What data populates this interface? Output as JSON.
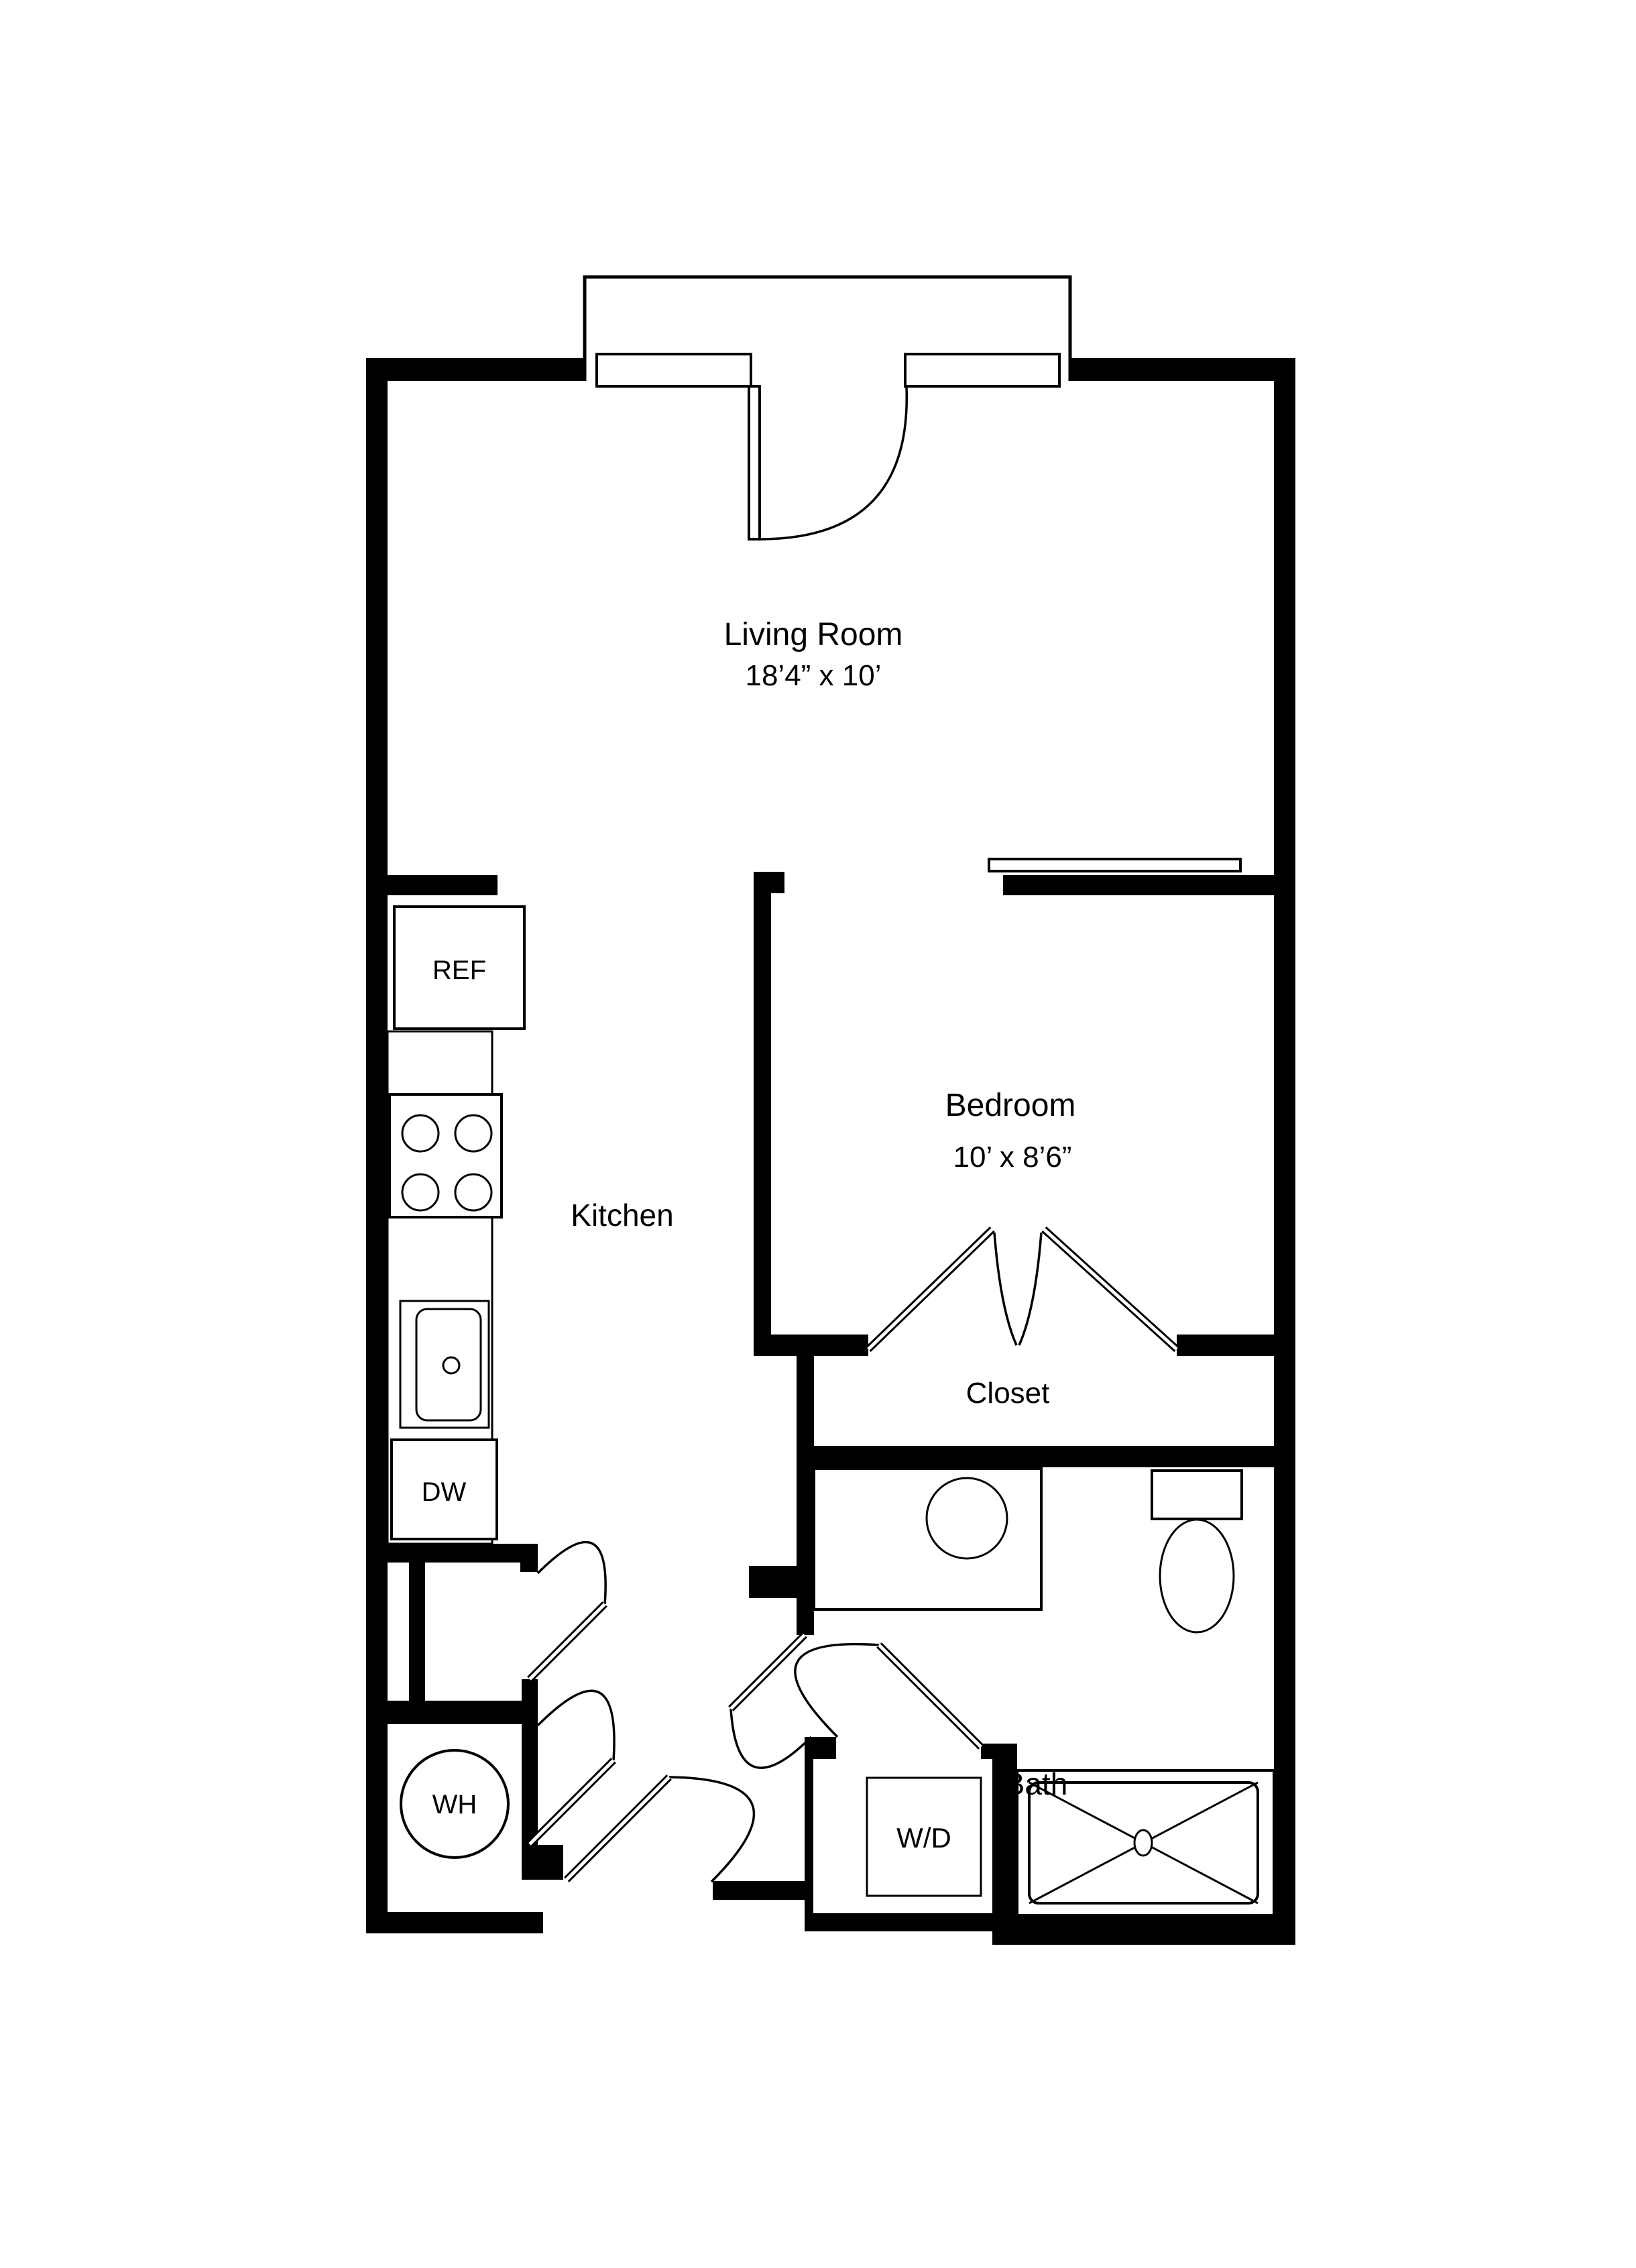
{
  "page": {
    "background": "#ffffff",
    "line_color": "#000000"
  },
  "rooms": {
    "living_room": {
      "label": "Living Room",
      "dimensions": "18’4” x 10’"
    },
    "kitchen": {
      "label": "Kitchen"
    },
    "bedroom": {
      "label": "Bedroom",
      "dimensions": "10’ x 8’6”"
    },
    "closet": {
      "label": "Closet"
    },
    "bath": {
      "label": "Bath"
    }
  },
  "appliances": {
    "refrigerator": "REF",
    "dishwasher": "DW",
    "water_heater": "WH",
    "washer_dryer": "W/D"
  }
}
